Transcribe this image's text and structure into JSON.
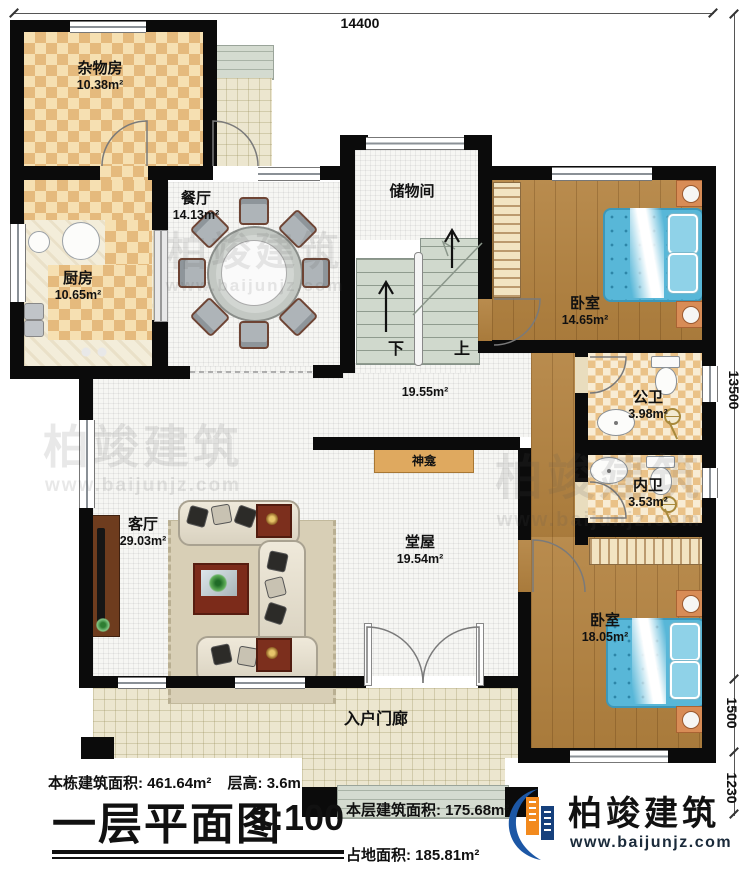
{
  "dims": {
    "top": "14400",
    "right": "13500",
    "r1500": "1500",
    "r1230": "1230"
  },
  "rooms": {
    "zawufang": {
      "name": "杂物房",
      "area": "10.38m²"
    },
    "canting": {
      "name": "餐厅",
      "area": "14.13m²"
    },
    "chufang": {
      "name": "厨房",
      "area": "10.65m²"
    },
    "chuwujian": {
      "name": "储物间"
    },
    "bedroom1": {
      "name": "卧室",
      "area": "14.65m²"
    },
    "gongwei": {
      "name": "公卫",
      "area": "3.98m²"
    },
    "neiwei": {
      "name": "内卫",
      "area": "3.53m²"
    },
    "bedroom2": {
      "name": "卧室",
      "area": "18.05m²"
    },
    "keting": {
      "name": "客厅",
      "area": "29.03m²"
    },
    "tangwu": {
      "name": "堂屋",
      "area": "19.54m²"
    },
    "hall": {
      "area": "19.55m²"
    },
    "shenkan": {
      "name": "神龛"
    },
    "porch": {
      "name": "入户门廊"
    }
  },
  "stairs": {
    "down": "下",
    "up": "上"
  },
  "footer": {
    "total_area_label": "本栋建筑面积: 461.64m²",
    "floor_height_label": "层高: 3.6m",
    "title": "一层平面图",
    "scale": "1:100",
    "floor_area_label": "本层建筑面积: 175.68m²",
    "footprint_label": "占地面积: 185.81m²"
  },
  "logo": {
    "name": "柏竣建筑",
    "url": "www.baijunjz.com"
  },
  "watermark": {
    "name": "柏竣建筑",
    "url": "www.baijunjz.com"
  },
  "colors": {
    "wall": "#0b0b0b",
    "logo_blue": "#1c57a5",
    "logo_orange": "#f28a1e"
  }
}
